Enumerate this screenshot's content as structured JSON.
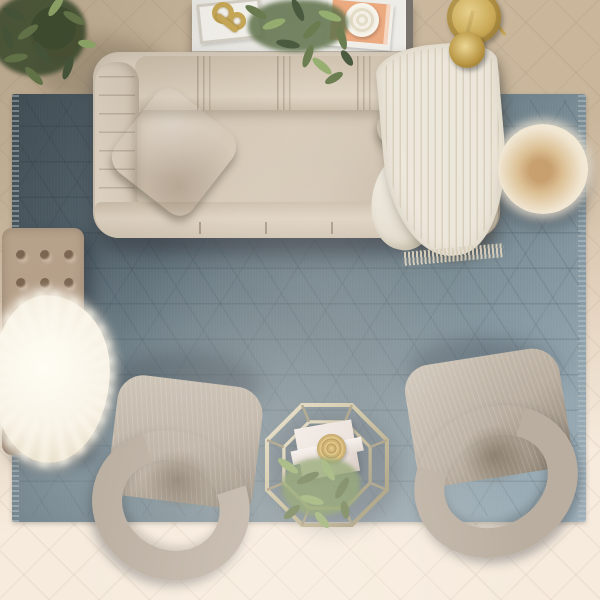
{
  "scene": {
    "type": "photograph",
    "view": "top-down overhead view",
    "setting": "styled living room on herringbone wood floor"
  },
  "objects": {
    "rug": {
      "label": "Blue-grey area rug with tone-on-tone geometric trellis pattern"
    },
    "sofa": {
      "label": "Beige channel-tufted upholstered sofa seen from above"
    },
    "pillow_left": {
      "label": "Blush ruched striped throw pillow on left sofa corner"
    },
    "pillow_right": {
      "label": "Blush ruched striped throw pillow on right sofa corner"
    },
    "throw_blanket": {
      "label": "Cream knit throw blanket draped over right sofa arm"
    },
    "console_table": {
      "label": "White console table behind sofa"
    },
    "tray": {
      "label": "White decorative tray"
    },
    "gold_sculpture": {
      "label": "Gold abstract ring sculpture"
    },
    "books": {
      "label": "Peach and white coffee-table books"
    },
    "candle": {
      "label": "Round cream candle on books"
    },
    "console_plant": {
      "label": "Trailing green eucalyptus plant on console"
    },
    "corner_plant": {
      "label": "Potted green plant in terracotta pot, top-left corner"
    },
    "floor_lamp": {
      "label": "Brass arc floor lamp seen from above"
    },
    "pouf": {
      "label": "Round cream fur pouf"
    },
    "ottoman": {
      "label": "Taupe button-tufted ottoman bench"
    },
    "fur_throw": {
      "label": "White shaggy sheepskin throw on ottoman"
    },
    "chair_left": {
      "label": "Grey barrel armchair, lower left, facing sofa"
    },
    "chair_right": {
      "label": "Grey barrel armchair, lower right, facing sofa"
    },
    "coffee_table": {
      "label": "Octagonal brass-frame glass coffee table"
    },
    "gift_box": {
      "label": "White folded box/booklet on coffee table"
    },
    "gold_plate": {
      "label": "Round woven gold charger on coffee table"
    },
    "table_plant": {
      "label": "Trailing green plant on coffee table"
    },
    "floor": {
      "label": "Herringbone wood floor, warm tan fading to cream"
    }
  },
  "palette": {
    "floor_top": "#c9b69b",
    "floor_mid": "#e3d1bd",
    "floor_bottom": "#f6ebdd",
    "rug_base": "#6d8089",
    "rug_dark": "#55656e",
    "rug_light": "#91a5b0",
    "rug_fringe": "#b9c3c6",
    "sofa_body": "#d7cab8",
    "sofa_dark": "#b4a590",
    "sofa_light": "#e4d9c9",
    "pillow_base": "#ddc4b2",
    "pillow_stripe": "#ad8a74",
    "pillow_light": "#f0e0d2",
    "throw_white": "#ece6da",
    "throw_line": "#cfc4ae",
    "ottoman_top": "#bca78f",
    "ottoman_dark": "#9a8570",
    "fur_white": "#f7f1e4",
    "pouf_outer": "#f0e5d0",
    "pouf_core": "#c89f6e",
    "chair_body": "#b9aea0",
    "chair_dark": "#8c8171",
    "chair_light": "#cdc4b6",
    "gold": "#c8a854",
    "champagne": "#cfc7b2",
    "plant_dark": "#45563a",
    "plant_mid": "#66794b",
    "plant_light": "#93ad6d",
    "pot": "#a97a5f",
    "table_top": "#edece7",
    "table_edge": "#75716a",
    "book_orange": "#eca87d",
    "book_white": "#f2efe9",
    "candle": "#f7f4ec",
    "gift_box": "#e9dfd9",
    "plate_gold": "#c2a154"
  }
}
